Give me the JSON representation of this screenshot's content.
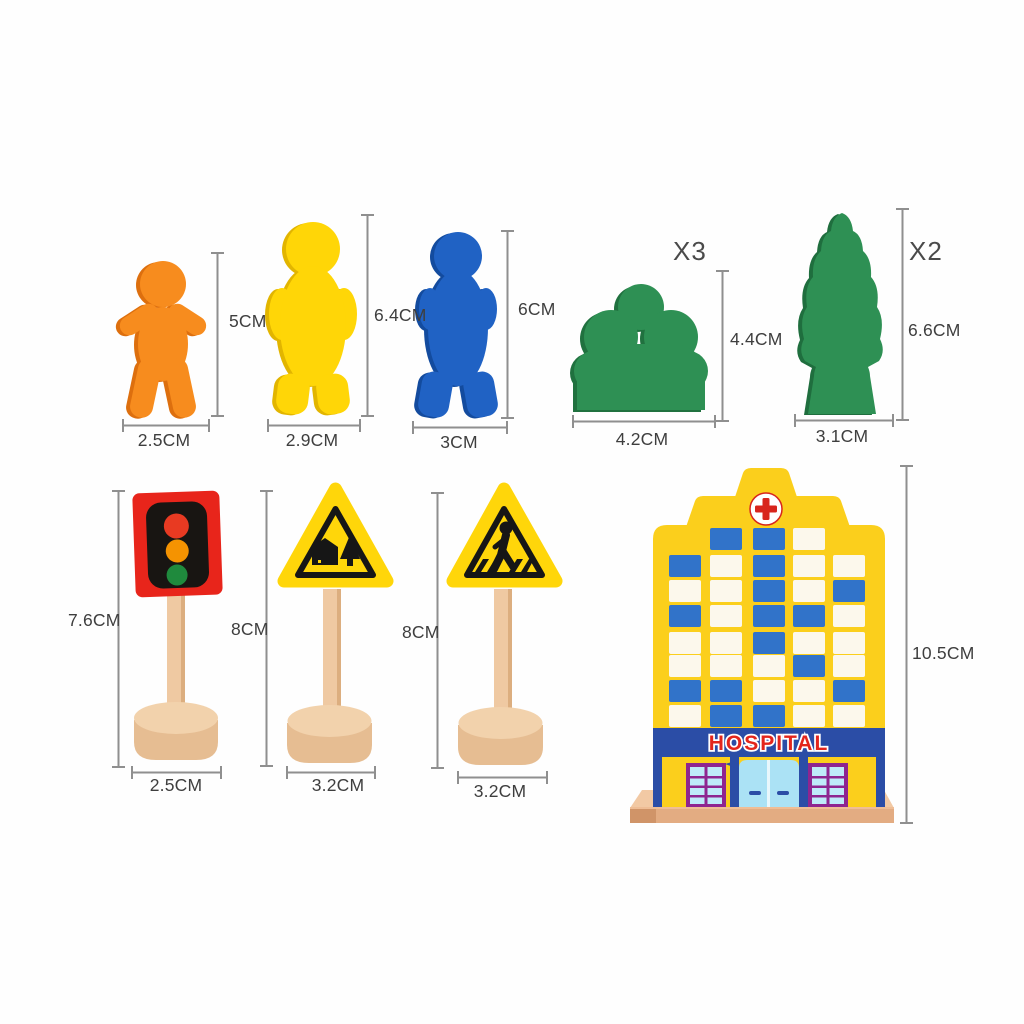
{
  "product": "wooden toy street set dimension diagram",
  "units": "CM",
  "dims": {
    "orange": {
      "h": "5CM",
      "w": "2.5CM"
    },
    "yellow": {
      "h": "6.4CM",
      "w": "2.9CM"
    },
    "blue": {
      "h": "6CM",
      "w": "3CM"
    },
    "bush": {
      "count": "X3",
      "h": "4.4CM",
      "w": "4.2CM"
    },
    "pine": {
      "count": "X2",
      "h": "6.6CM",
      "w": "3.1CM"
    },
    "traffic_light": {
      "h": "7.6CM",
      "w": "2.5CM"
    },
    "village_sign": {
      "h": "8CM",
      "w": "3.2CM"
    },
    "crossing_sign": {
      "h": "8CM",
      "w": "3.2CM"
    },
    "hospital": {
      "h": "10.5CM"
    }
  },
  "hospital": {
    "sign_text": "HOSPITAL",
    "window_pattern": [
      "_bbw_",
      "bwbww",
      "wwbwb",
      "bwbbw",
      "wwbww",
      "wwwbw",
      "bbwwb",
      "wbbww"
    ],
    "window_blue": "#3173C9",
    "window_white": "#FCF8EC"
  },
  "colors": {
    "figure_orange": "#F78C1E",
    "figure_yellow": "#FFD607",
    "figure_blue": "#2062C4",
    "tree_green": "#2E9054",
    "sign_yellow": "#FFD60A",
    "traffic_box_red": "#E8251B",
    "light_red": "#E83A22",
    "light_orange": "#F59301",
    "light_green": "#1F8A3D",
    "wood_tan": "#EFC9A2",
    "hospital_yellow": "#FBCF1C",
    "banner_blue": "#2B4DA6",
    "cross_red": "#D8251C",
    "hospital_text_red": "#E3251C",
    "platform_tan": "#E3AC82",
    "dimension_gray": "#8F8F8F"
  }
}
